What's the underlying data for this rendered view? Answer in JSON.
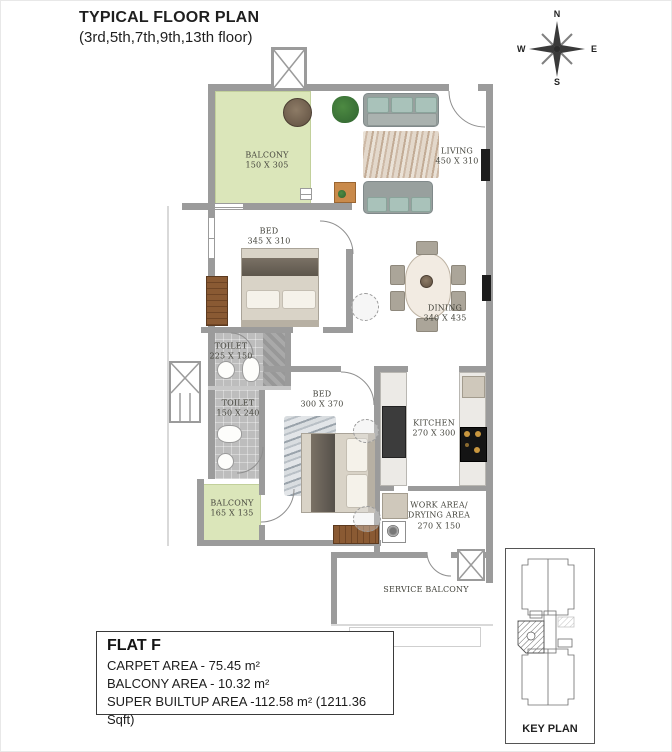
{
  "title": {
    "line1": "TYPICAL FLOOR PLAN",
    "line2": "(3rd,5th,7th,9th,13th floor)"
  },
  "compass": {
    "n": "N",
    "e": "E",
    "s": "S",
    "w": "W"
  },
  "rooms": {
    "balcony1": {
      "name": "BALCONY",
      "dim": "150 X 305"
    },
    "living": {
      "name": "LIVING",
      "dim": "450 X 310"
    },
    "bed1": {
      "name": "BED",
      "dim": "345 X 310"
    },
    "dining": {
      "name": "DINING",
      "dim": "340 X 435"
    },
    "toilet1": {
      "name": "TOILET",
      "dim": "225 X 150"
    },
    "toilet2": {
      "name": "TOILET",
      "dim": "150 X 240"
    },
    "bed2": {
      "name": "BED",
      "dim": "300 X 370"
    },
    "kitchen": {
      "name": "KITCHEN",
      "dim": "270 X 300"
    },
    "balcony2": {
      "name": "BALCONY",
      "dim": "165 X 135"
    },
    "work_area": {
      "name": "WORK AREA/",
      "name2": "DRYING AREA",
      "dim": "270 X 150"
    },
    "service_balcony": {
      "name": "SERVICE BALCONY"
    }
  },
  "info": {
    "flat": "FLAT F",
    "carpet": "CARPET AREA - 75.45 m²",
    "balcony": "BALCONY AREA - 10.32 m²",
    "super_builtup": "SUPER BUILTUP AREA -112.58 m² (1211.36 Sqft)"
  },
  "key_plan": {
    "label": "KEY PLAN"
  },
  "colors": {
    "wall": "#9b9b9b",
    "balcony_floor": "#dbe6ba",
    "compass_needle": "#a63226",
    "toilet_tile": "#bdbdbd"
  }
}
